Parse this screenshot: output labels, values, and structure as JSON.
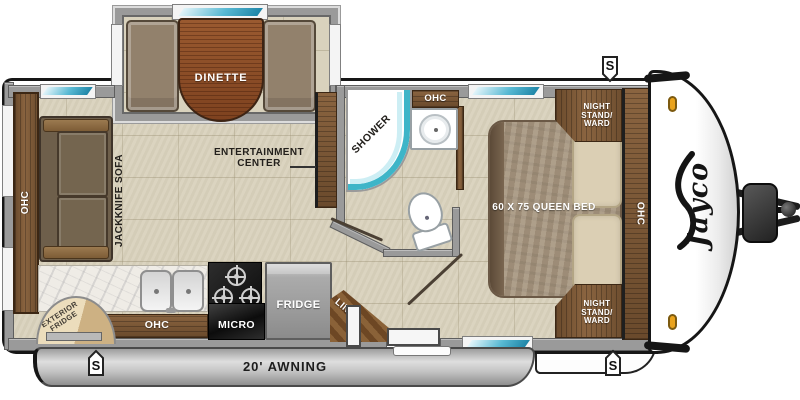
{
  "brand": {
    "logo": "Jayco"
  },
  "rooms": {
    "dinette": {
      "label": "DINETTE"
    },
    "living": {
      "entertainment_center_label": "ENTERTAINMENT CENTER",
      "sofa_label": "JACKKNIFE SOFA",
      "rear_cabinet_label": "OHC"
    },
    "bathroom": {
      "shower_label": "SHOWER",
      "overhead_cabinet_label": "OHC"
    },
    "kitchen": {
      "overhead_cabinet_label": "OHC",
      "microwave_label": "MICRO",
      "fridge_label": "FRIDGE",
      "linen_label": "LINEN",
      "exterior_fridge_label": "EXTERIOR FRIDGE"
    },
    "bedroom": {
      "bed_label": "60 X 75 QUEEN BED",
      "nightstand_front_label": "NIGHT STAND/ WARD",
      "nightstand_rear_label": "NIGHT STAND/ WARD",
      "overhead_cabinet_label": "OHC"
    }
  },
  "exterior": {
    "awning_label": "20' AWNING",
    "speaker_symbol": "S"
  },
  "colors": {
    "floor_tile": "#d9d2bd",
    "wall_gray": "#9a9a9a",
    "cabinet_wood": "#7a5838",
    "dinette_table_wood": "#8a4a28",
    "upholstery": "#6e5f4b",
    "bed_spread": "#a5947d",
    "pillow": "#dbcfb4",
    "shower_accent_teal": "#3eb5c8",
    "awning_silver": "#c4c4c4",
    "marker_light_amber": "#eaa31d",
    "counter_marble": "#efece6"
  }
}
